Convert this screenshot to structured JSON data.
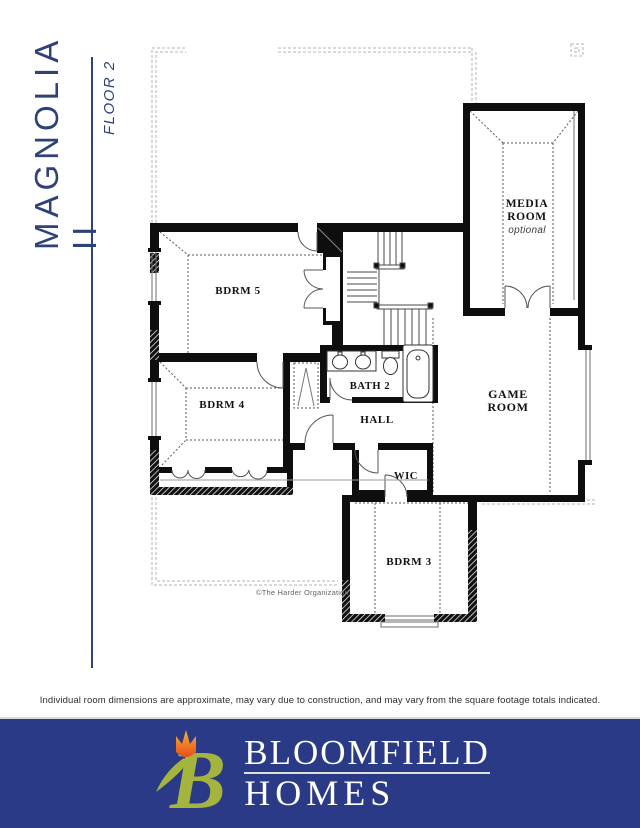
{
  "sidebar": {
    "title": "MAGNOLIA II",
    "floor_label": "FLOOR 2"
  },
  "plan": {
    "rooms": [
      {
        "id": "bdrm5",
        "label": "BDRM 5"
      },
      {
        "id": "bdrm4",
        "label": "BDRM 4"
      },
      {
        "id": "bath2",
        "label": "BATH 2"
      },
      {
        "id": "hall",
        "label": "HALL"
      },
      {
        "id": "wic",
        "label": "WIC"
      },
      {
        "id": "bdrm3",
        "label": "BDRM 3"
      },
      {
        "id": "game",
        "line1": "GAME",
        "line2": "ROOM"
      },
      {
        "id": "media",
        "line1": "MEDIA",
        "line2": "ROOM",
        "sublabel": "optional"
      }
    ],
    "copyright": "©The Harder Organization"
  },
  "footer": {
    "disclaimer": "Individual room dimensions are approximate, may vary due to construction, and may vary from the square footage totals indicated.",
    "brand_top": "BLOOMFIELD",
    "brand_bottom": "HOMES"
  },
  "colors": {
    "masthead_navy": "#2e4178",
    "banner_blue": "#2a3a86",
    "logo_green": "#a4b43f",
    "tulip_orange": "#f39c1e",
    "tulip_red": "#e54e1b",
    "wall_black": "#0e0e0e"
  }
}
